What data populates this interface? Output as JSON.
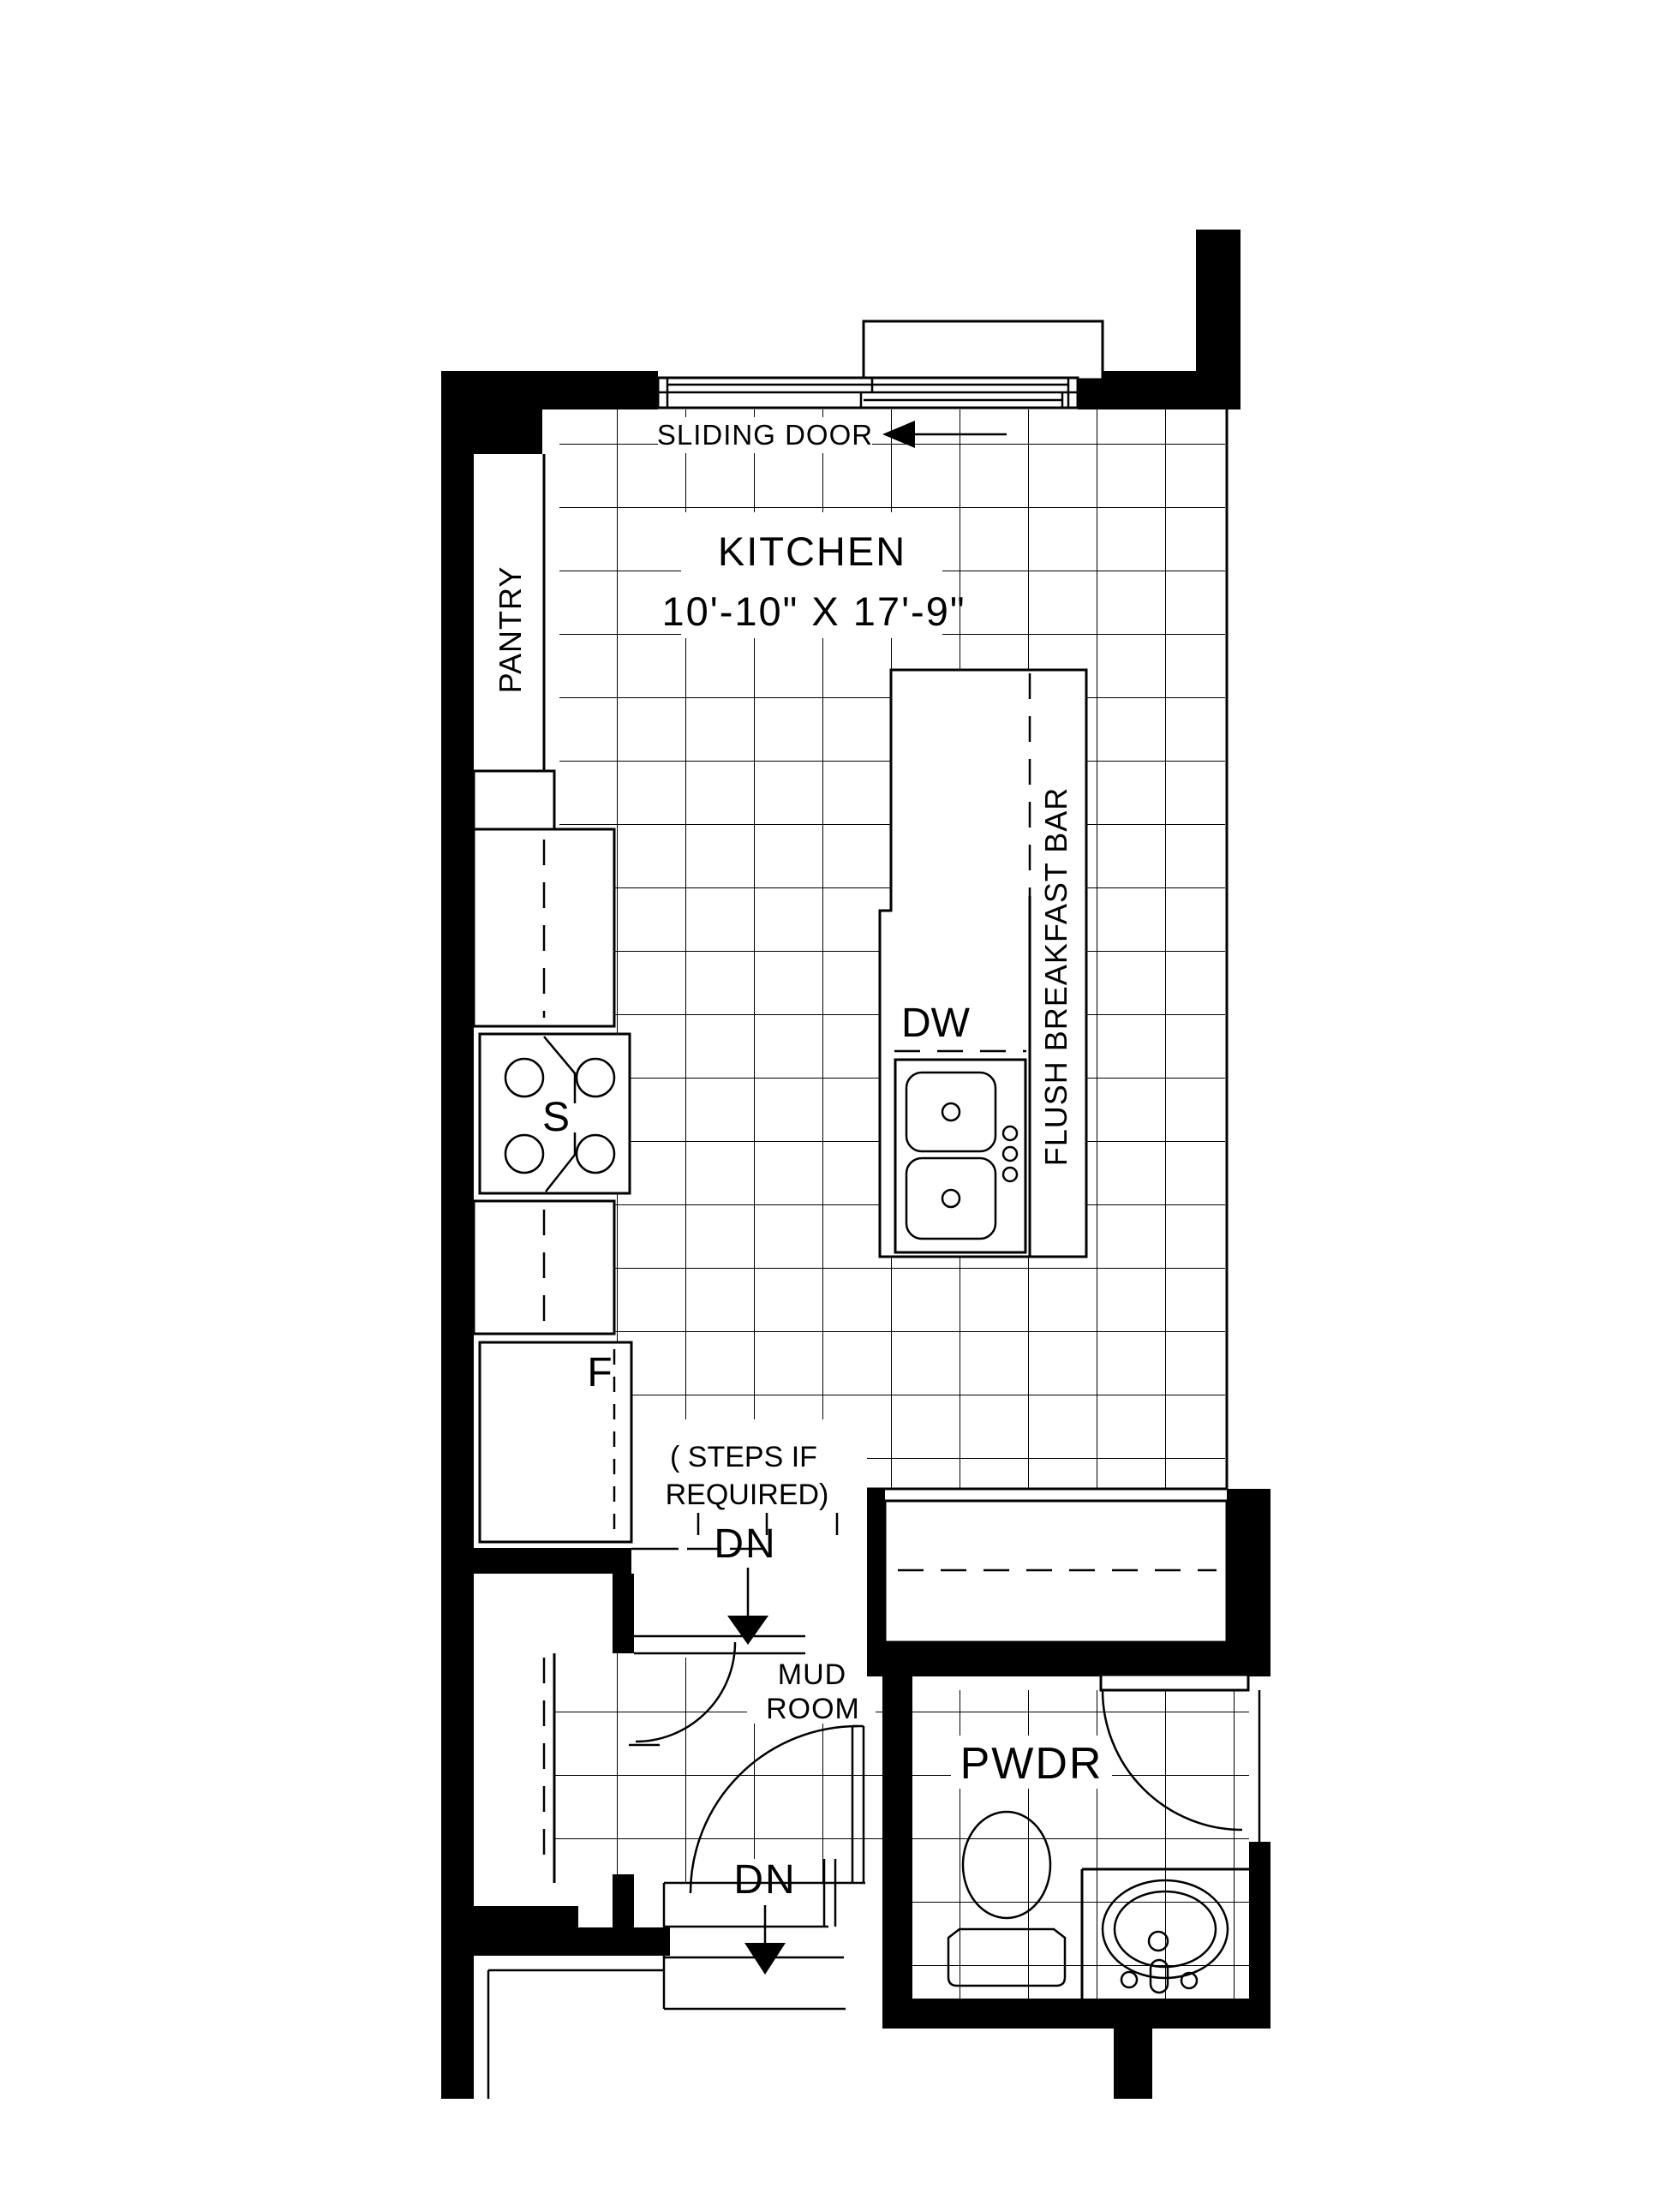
{
  "meta": {
    "title": "Kitchen floor plan",
    "colors": {
      "ink": "#000000",
      "paper": "#ffffff"
    }
  },
  "rooms": {
    "kitchen": {
      "name": "KITCHEN",
      "dims": "10'-10\" X 17'-9\""
    },
    "pantry": {
      "name": "PANTRY"
    },
    "mud_room": {
      "line1": "MUD",
      "line2": "ROOM"
    },
    "powder": {
      "name": "PWDR"
    }
  },
  "features": {
    "sliding_door": "SLIDING DOOR",
    "breakfast_bar": "FLUSH BREAKFAST BAR",
    "dishwasher": "DW",
    "stove": "S",
    "fridge": "F",
    "steps_note_line1": "( STEPS IF",
    "steps_note_line2": "REQUIRED)",
    "down_from_kitchen": "DN",
    "down_from_mud_room": "DN"
  }
}
